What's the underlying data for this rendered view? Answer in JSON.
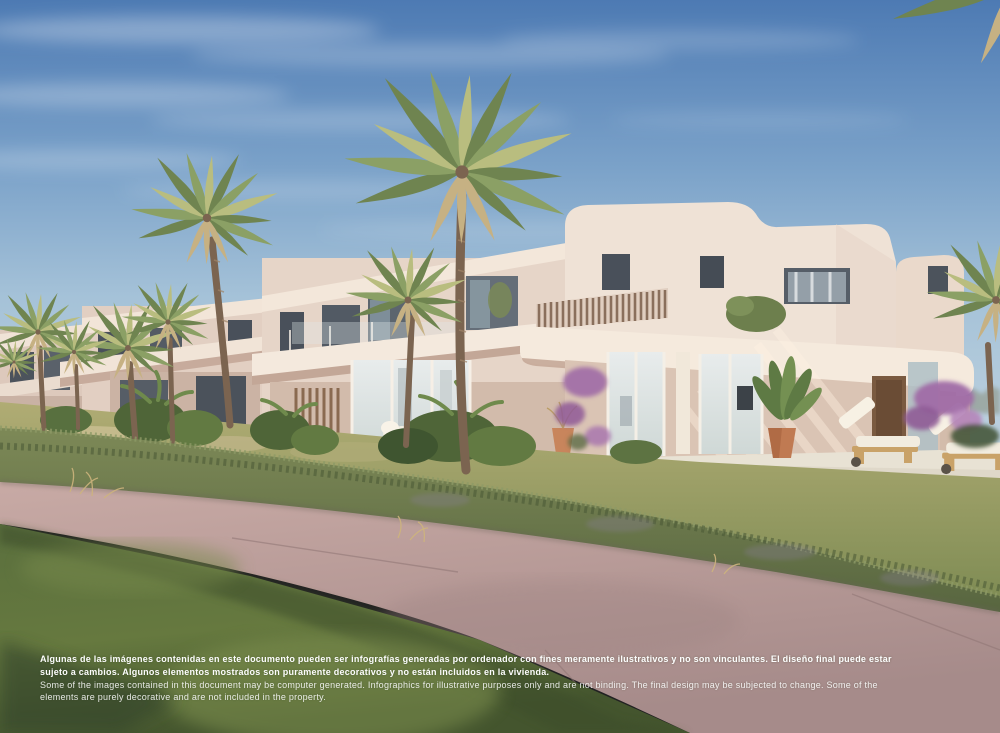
{
  "image": {
    "kind": "architectural-render-photo",
    "description": "Computer-generated render of a row of modern cream villas with palm trees, gardens, a pool with sun loungers, a diagonal footpath and lawn in the foreground under a blue sky",
    "elements": [
      "sky",
      "cirrus-clouds",
      "villa-row",
      "main-villa",
      "slatted-screen",
      "balcony-band",
      "glass-doors",
      "wood-door",
      "palm-trees",
      "bougainvillea",
      "potted-plant",
      "pool",
      "sun-loungers",
      "terrace",
      "hedge",
      "footpath",
      "lawn",
      "distant-hills"
    ],
    "palette": {
      "sky_top": "#4d7ab3",
      "sky_horizon": "#b9cfdd",
      "villa_sunlit": "#eee1d5",
      "villa_shadow": "#d8c2b4",
      "fascia_white": "#f4e9dd",
      "window_dark": "#49505a",
      "wood": "#8a6a50",
      "palm_green": "#8ba065",
      "hedge_green": "#6b7a4f",
      "lawn_green": "#9fa369",
      "grass_dark": "#4a5d35",
      "path_pink": "#bfa19d",
      "pool_blue": "#8ab8c8",
      "terracotta": "#c07a52",
      "bougainvillea": "#a06ba6",
      "text_white": "#fdfdfd"
    }
  },
  "disclaimer": {
    "es_line1": "Algunas de las imágenes contenidas en este documento pueden ser infografías generadas por ordenador con fines meramente ilustrativos y no son vinculantes. El diseño final puede estar",
    "es_line2": "sujeto a cambios. Algunos elementos mostrados son puramente decorativos y no están incluidos en la vivienda.",
    "en_line1": "Some of the images contained in this document may be computer generated. Infographics for illustrative purposes only and are not binding. The final design may be subjected to change. Some of the",
    "en_line2": "elements are purely decorative and are not included in the property."
  }
}
